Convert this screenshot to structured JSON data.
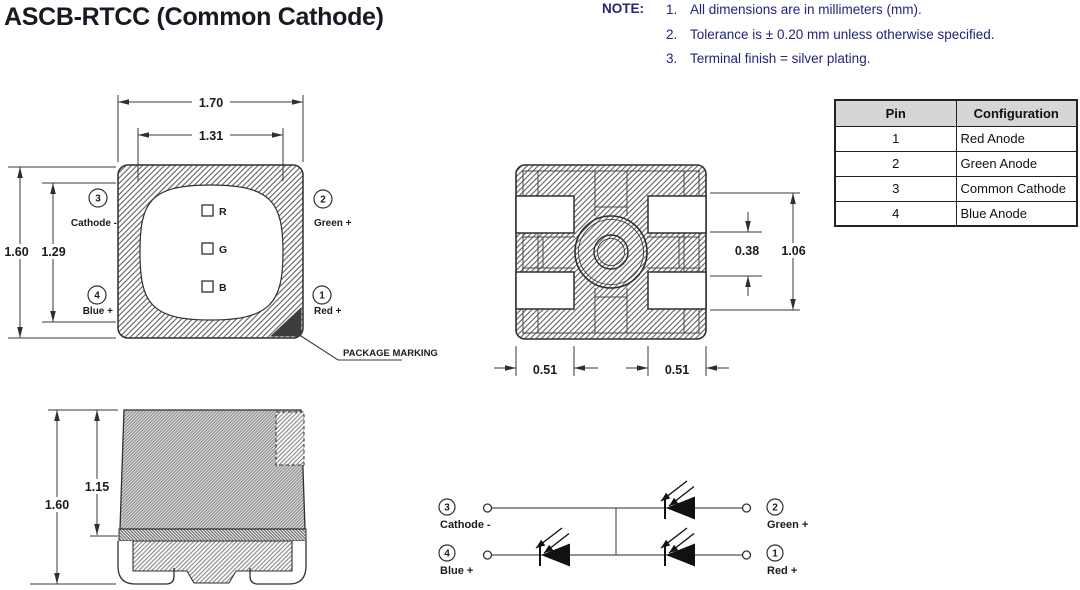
{
  "title": "ASCB-RTCC (Common Cathode)",
  "notes": {
    "heading": "NOTE:",
    "items": [
      {
        "num": "1.",
        "text": "All dimensions are in millimeters (mm)."
      },
      {
        "num": "2.",
        "text": "Tolerance is ± 0.20 mm unless otherwise specified."
      },
      {
        "num": "3.",
        "text": "Terminal finish = silver plating."
      }
    ]
  },
  "pin_table": {
    "headers": [
      "Pin",
      "Configuration"
    ],
    "rows": [
      [
        "1",
        "Red Anode"
      ],
      [
        "2",
        "Green Anode"
      ],
      [
        "3",
        "Common Cathode"
      ],
      [
        "4",
        "Blue Anode"
      ]
    ]
  },
  "top_view": {
    "dim_width_outer": "1.70",
    "dim_width_inner": "1.31",
    "dim_height_outer": "1.60",
    "dim_height_inner": "1.29",
    "chips": {
      "r": "R",
      "g": "G",
      "b": "B"
    },
    "pins": {
      "p3": {
        "num": "3",
        "label": "Cathode -"
      },
      "p2": {
        "num": "2",
        "label": "Green +"
      },
      "p4": {
        "num": "4",
        "label": "Blue +"
      },
      "p1": {
        "num": "1",
        "label": "Red +"
      }
    },
    "marking_label": "PACKAGE MARKING"
  },
  "bottom_view": {
    "dim_gap": "0.38",
    "dim_span": "1.06",
    "dim_pad_left": "0.51",
    "dim_pad_right": "0.51"
  },
  "side_view": {
    "dim_total": "1.60",
    "dim_body": "1.15"
  },
  "schematic": {
    "p3": {
      "num": "3",
      "label": "Cathode -"
    },
    "p4": {
      "num": "4",
      "label": "Blue +"
    },
    "p2": {
      "num": "2",
      "label": "Green +"
    },
    "p1": {
      "num": "1",
      "label": "Red +"
    }
  },
  "colors": {
    "title_text": "#191923",
    "note_text": "#23237d",
    "line": "#2f2f2f",
    "table_header_bg": "#d6d6d6"
  }
}
